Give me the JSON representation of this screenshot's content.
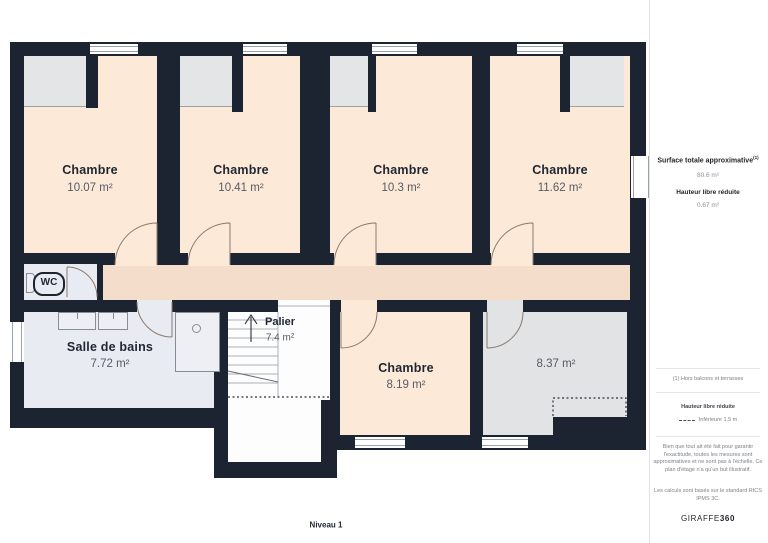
{
  "plan": {
    "level_label": "Niveau 1",
    "rooms": {
      "chambre1": {
        "name": "Chambre",
        "area": "10.07 m²"
      },
      "chambre2": {
        "name": "Chambre",
        "area": "10.41 m²"
      },
      "chambre3": {
        "name": "Chambre",
        "area": "10.3 m²"
      },
      "chambre4": {
        "name": "Chambre",
        "area": "11.62 m²"
      },
      "chambre5": {
        "name": "Chambre",
        "area": "8.19 m²"
      },
      "salle_de_bains": {
        "name": "Salle de bains",
        "area": "7.72 m²"
      },
      "palier": {
        "name": "Palier",
        "area": "7.4 m²"
      },
      "combles": {
        "area": "8.37 m²"
      },
      "wc": {
        "name": "WC"
      }
    },
    "colors": {
      "wall": "#1b2430",
      "room": "#fce9d8",
      "corridor": "#f4ddca",
      "closet": "#e3e5e7",
      "bathroom": "#e9ebf2",
      "reduced_room": "#e1e3e5"
    }
  },
  "sidebar": {
    "surface_title": "Surface totale approximative",
    "surface_footnote_marker": "(1)",
    "surface_value": "80.6 m²",
    "reduced_height_title": "Hauteur libre réduite",
    "reduced_height_value": "0.67 m²",
    "footnote": "(1) Hors balcons et terrasses",
    "legend_title": "Hauteur libre réduite",
    "legend_item": "Inférieure 1.5 m",
    "disclaimer": "Bien que tout ait été fait pour garantir l'exactitude, toutes les mesures sont approximatives et ne sont pas à l'échelle. Ce plan d'étage n'a qu'un but illustratif.",
    "standard_note": "Les calculs sont basés sur le standard RICS IPMS 3C.",
    "brand_light": "GIRAFFE",
    "brand_bold": "360"
  }
}
